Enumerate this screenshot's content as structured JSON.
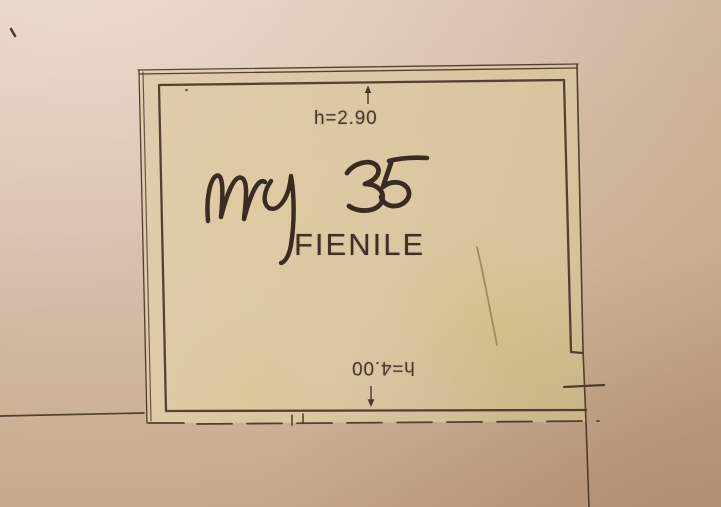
{
  "plan": {
    "room": {
      "name": "FIENILE",
      "area_note": "mq 35",
      "area_unit": "mq",
      "area_value": "35",
      "height_upper": "h=2.90",
      "height_lower": "h=4.00"
    },
    "icons": {
      "upper_dimension_arrow": "arrow-up-icon",
      "lower_dimension_arrow": "arrow-down-icon"
    },
    "colors": {
      "paper_light": "#ead9cb",
      "paper_dark": "#c0a085",
      "room_fill": "#dcc8a4",
      "stain_yellow": "#cdbc5f",
      "drawing_line": "#4a3626",
      "pen_ink": "#2e2019",
      "label_text": "#3f2f26"
    }
  }
}
